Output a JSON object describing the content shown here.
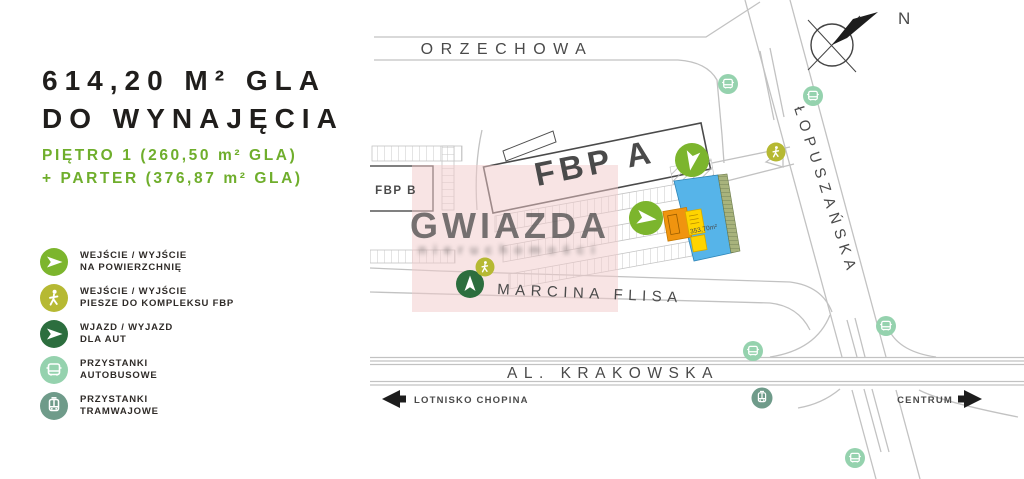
{
  "panel": {
    "title_line1": "614,20 M² GLA",
    "title_line2": "DO WYNAJĘCIA",
    "subtitle_line1": "PIĘTRO 1 (260,50 m² GLA)",
    "subtitle_line2": "+ PARTER (376,87 m² GLA)",
    "accent_green": "#6fae2c",
    "legend": [
      {
        "icon": "surface-exit-arrow-icon",
        "color": "#7cb52d",
        "line1": "WEJŚCIE / WYJŚCIE",
        "line2": "NA POWIERZCHNIĘ"
      },
      {
        "icon": "pedestrian-icon",
        "color": "#b6b933",
        "line1": "WEJŚCIE / WYJŚCIE",
        "line2": "PIESZE DO KOMPLEKSU FBP"
      },
      {
        "icon": "car-entry-arrow-icon",
        "color": "#2c6e3e",
        "line1": "WJAZD / WYJAZD",
        "line2": "DLA AUT"
      },
      {
        "icon": "bus-icon",
        "color": "#95d2ae",
        "line1": "PRZYSTANKI",
        "line2": "AUTOBUSOWE"
      },
      {
        "icon": "tram-icon",
        "color": "#6f9b8a",
        "line1": "PRZYSTANKI",
        "line2": "TRAMWAJOWE"
      }
    ]
  },
  "map": {
    "streets": {
      "top": "ORZECHOWA",
      "diagonal": "ŁOPUSZAŃSKA",
      "middle": "MARCINA FLISA",
      "bottom": "AL. KRAKOWSKA"
    },
    "buildings": {
      "a": "FBP A",
      "b": "FBP B"
    },
    "area_label": "353,70m²",
    "directions": {
      "west": "LOTNISKO CHOPINA",
      "east": "CENTRUM"
    },
    "compass": "N",
    "watermark": {
      "text": "GWIAZDA",
      "subtext": "nieruchomości"
    },
    "colors": {
      "blue": "#56b4e9",
      "pink": "#f2caca",
      "orange": "#f0940f",
      "yellow": "#ffd400"
    }
  }
}
